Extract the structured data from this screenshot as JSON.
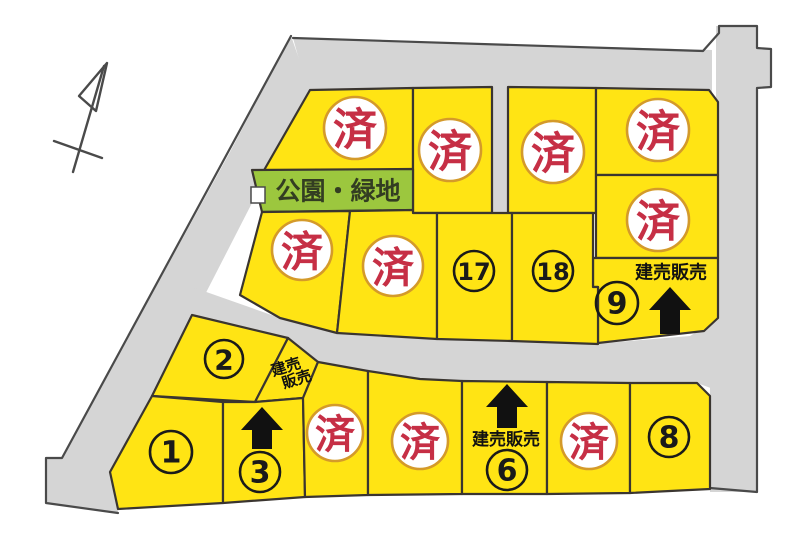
{
  "legend": {
    "sold_label": "済",
    "sale_label": "建売販売"
  },
  "park": {
    "label": "公園・緑地"
  },
  "lots": [
    {
      "id": "upper-1",
      "label": "済"
    },
    {
      "id": "upper-2",
      "label": "済"
    },
    {
      "id": "upper-3",
      "label": "済"
    },
    {
      "id": "upper-right-1",
      "label": "済"
    },
    {
      "id": "upper-right-2",
      "label": "済"
    },
    {
      "id": "upper-4",
      "label": "済"
    },
    {
      "id": "upper-5",
      "label": "済"
    },
    {
      "id": "lot-17",
      "label": "17"
    },
    {
      "id": "lot-18",
      "label": "18"
    },
    {
      "id": "lot-9",
      "label": "9",
      "sale_label": "建売販売"
    },
    {
      "id": "lot-2",
      "label": "2"
    },
    {
      "id": "lot-3-flag",
      "sale_label_line1": "建売",
      "sale_label_line2": "販売"
    },
    {
      "id": "lot-1",
      "label": "1"
    },
    {
      "id": "lot-3",
      "label": "3"
    },
    {
      "id": "lower-4",
      "label": "済"
    },
    {
      "id": "lower-5",
      "label": "済"
    },
    {
      "id": "lot-6",
      "label": "6",
      "sale_label": "建売販売"
    },
    {
      "id": "lower-7",
      "label": "済"
    },
    {
      "id": "lot-8",
      "label": "8"
    }
  ],
  "colors": {
    "background": "#ffffff",
    "road_fill": "#d5d5d5",
    "road_outline": "#4a4a4a",
    "lot_fill": "#ffe414",
    "lot_outline": "#3a3530",
    "park_fill": "#9cc73e",
    "sold_ring": "#d49a2a",
    "sold_text": "#c62f45",
    "number_text": "#1a1a1a"
  }
}
